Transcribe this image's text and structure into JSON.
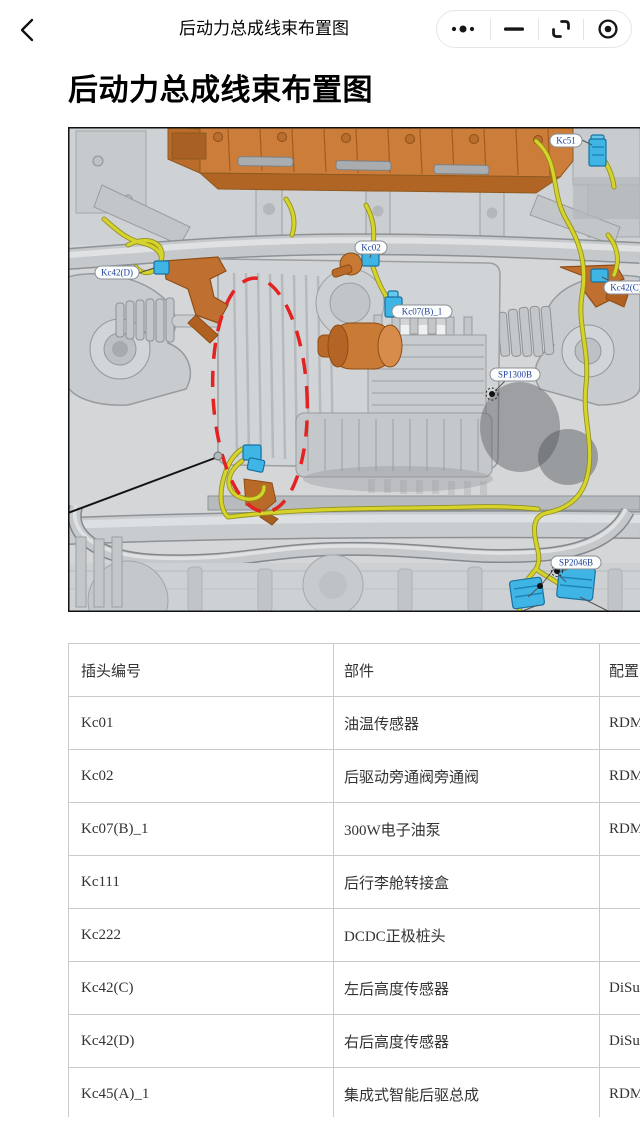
{
  "nav": {
    "title": "后动力总成线束布置图",
    "back": "chevron-left",
    "capsule": {
      "more": "three-dots",
      "minimize": "minus",
      "restore": "corner-brackets",
      "target": "circle-dot"
    }
  },
  "page": {
    "heading": "后动力总成线束布置图"
  },
  "diagram": {
    "description": "后动力总成线束布置图 underbody CAD illustration",
    "colors": {
      "label_text": "#1d3f9a",
      "harness_yellow": "#d6d32b",
      "connector_blue": "#3fb5e6",
      "part_orange": "#c97a35",
      "highlight_red": "#e32222"
    },
    "labels": [
      {
        "id": "Kc51",
        "x": 482,
        "y": 7,
        "w": 32
      },
      {
        "id": "Kc02",
        "x": 287,
        "y": 114,
        "w": 32
      },
      {
        "id": "Kc42(D)",
        "x": 27,
        "y": 139,
        "w": 44
      },
      {
        "id": "Kc42(C)",
        "x": 536,
        "y": 154,
        "w": 44
      },
      {
        "id": "Kc07(B)_1",
        "x": 324,
        "y": 178,
        "w": 60
      },
      {
        "id": "SP1300B",
        "x": 422,
        "y": 241,
        "w": 50
      },
      {
        "id": "SP2046B",
        "x": 483,
        "y": 429,
        "w": 50
      }
    ]
  },
  "table": {
    "headers": [
      "插头编号",
      "部件",
      "配置"
    ],
    "rows": [
      [
        "Kc01",
        "油温传感器",
        "RDM"
      ],
      [
        "Kc02",
        "后驱动旁通阀旁通阀",
        "RDM"
      ],
      [
        "Kc07(B)_1",
        "300W电子油泵",
        "RDM"
      ],
      [
        "Kc111",
        "后行李舱转接盒",
        ""
      ],
      [
        "Kc222",
        "DCDC正极桩头",
        ""
      ],
      [
        "Kc42(C)",
        "左后高度传感器",
        "DiSu"
      ],
      [
        "Kc42(D)",
        "右后高度传感器",
        "DiSu"
      ],
      [
        "Kc45(A)_1",
        "集成式智能后驱总成",
        "RDM"
      ]
    ]
  }
}
